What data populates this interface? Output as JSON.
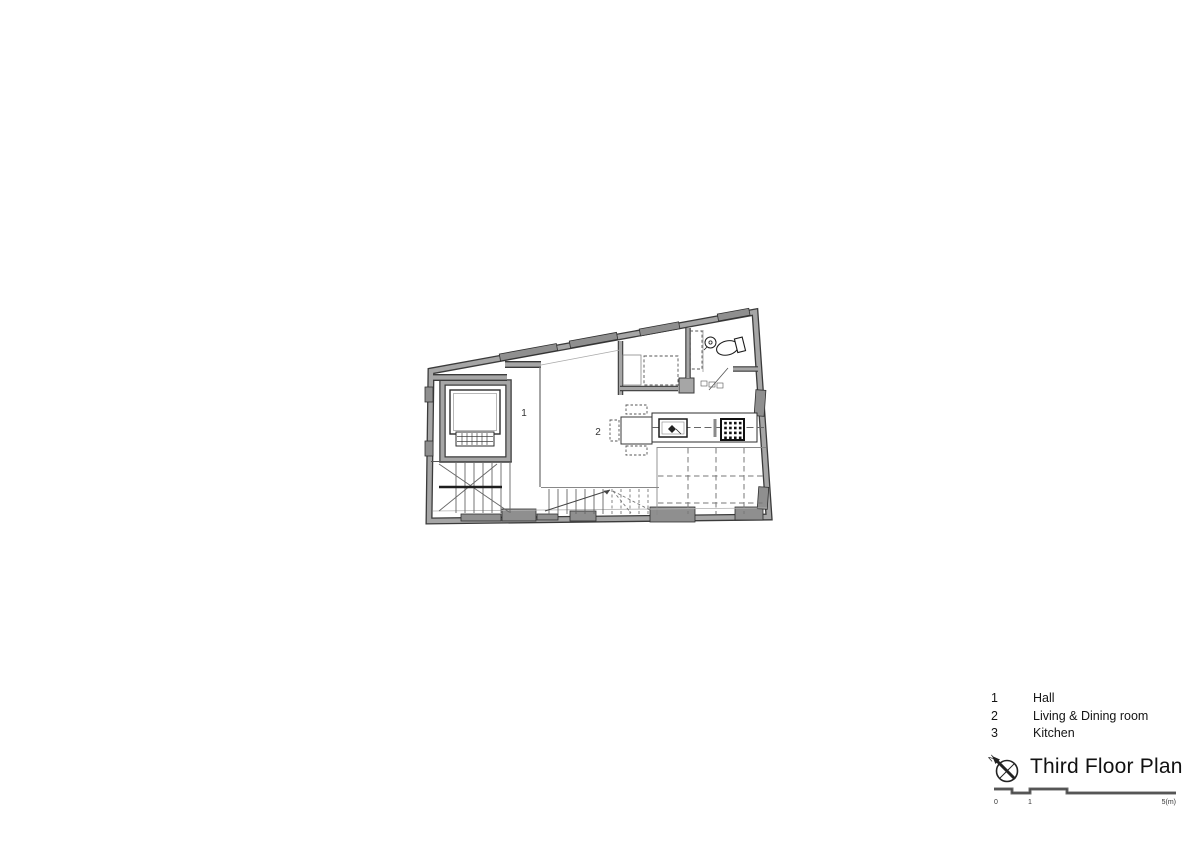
{
  "sheet": {
    "type": "architectural floor plan drawing",
    "background": "#ffffff"
  },
  "plan": {
    "room_labels": [
      {
        "number": "1"
      },
      {
        "number": "2"
      }
    ],
    "colors": {
      "wall_gray": "#a6a6a6",
      "wall_dark": "#3b3b3b",
      "window_gray": "#8f8f8f",
      "line_dark": "#222222",
      "line_mid": "#666666"
    }
  },
  "legend": {
    "items": [
      {
        "number": "1",
        "label": "Hall"
      },
      {
        "number": "2",
        "label": "Living & Dining room"
      },
      {
        "number": "3",
        "label": "Kitchen"
      }
    ]
  },
  "title": {
    "text": "Third Floor Plan",
    "north_label": "N"
  },
  "scale_bar": {
    "labels": [
      {
        "text": "0"
      },
      {
        "text": "1"
      },
      {
        "text": "5(m)"
      }
    ]
  }
}
